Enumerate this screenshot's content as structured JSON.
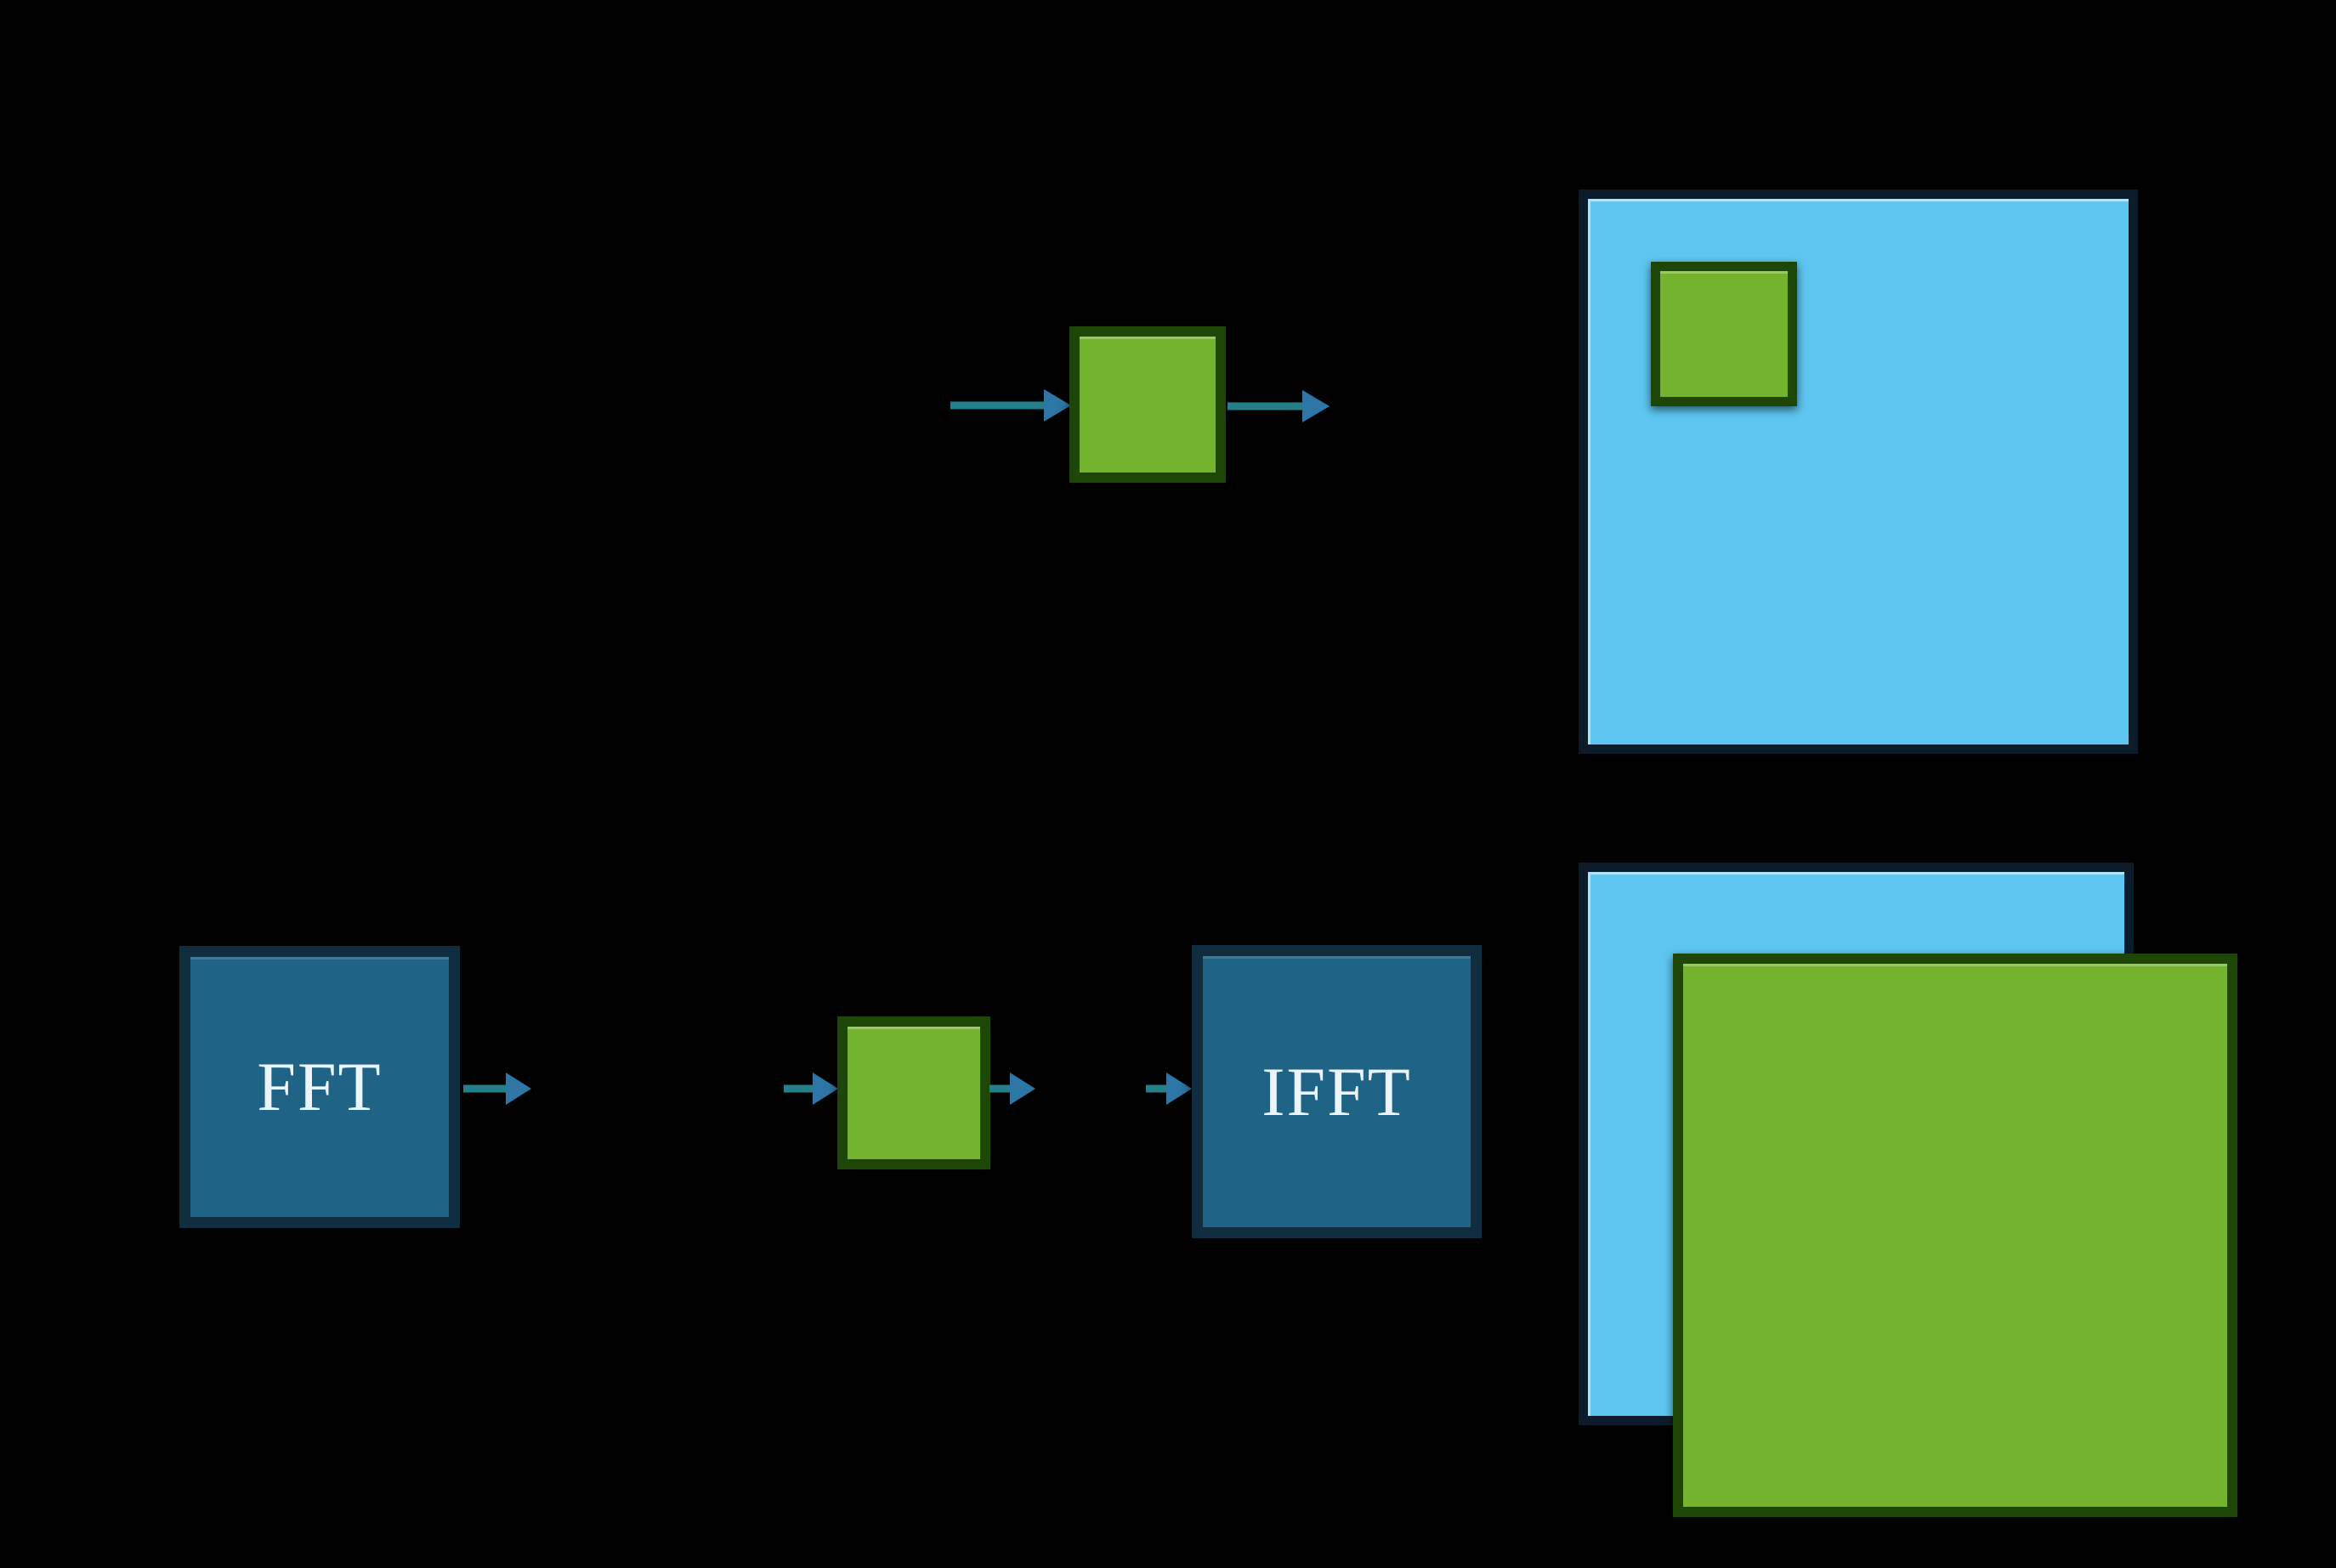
{
  "diagram": {
    "fft_label": "FFT",
    "ifft_label": "IFFT"
  },
  "colors": {
    "background": "#000000",
    "kernel_fill": "#74b32e",
    "kernel_border": "#1e4607",
    "image_fill": "#5dc6f0",
    "image_border": "#0d1c2b",
    "transform_fill": "#1f6387",
    "transform_border": "#102c3f",
    "transform_label_text": "#ecf5fd",
    "arrow_shaft": "#23808a",
    "arrow_head": "#2e76a6"
  }
}
